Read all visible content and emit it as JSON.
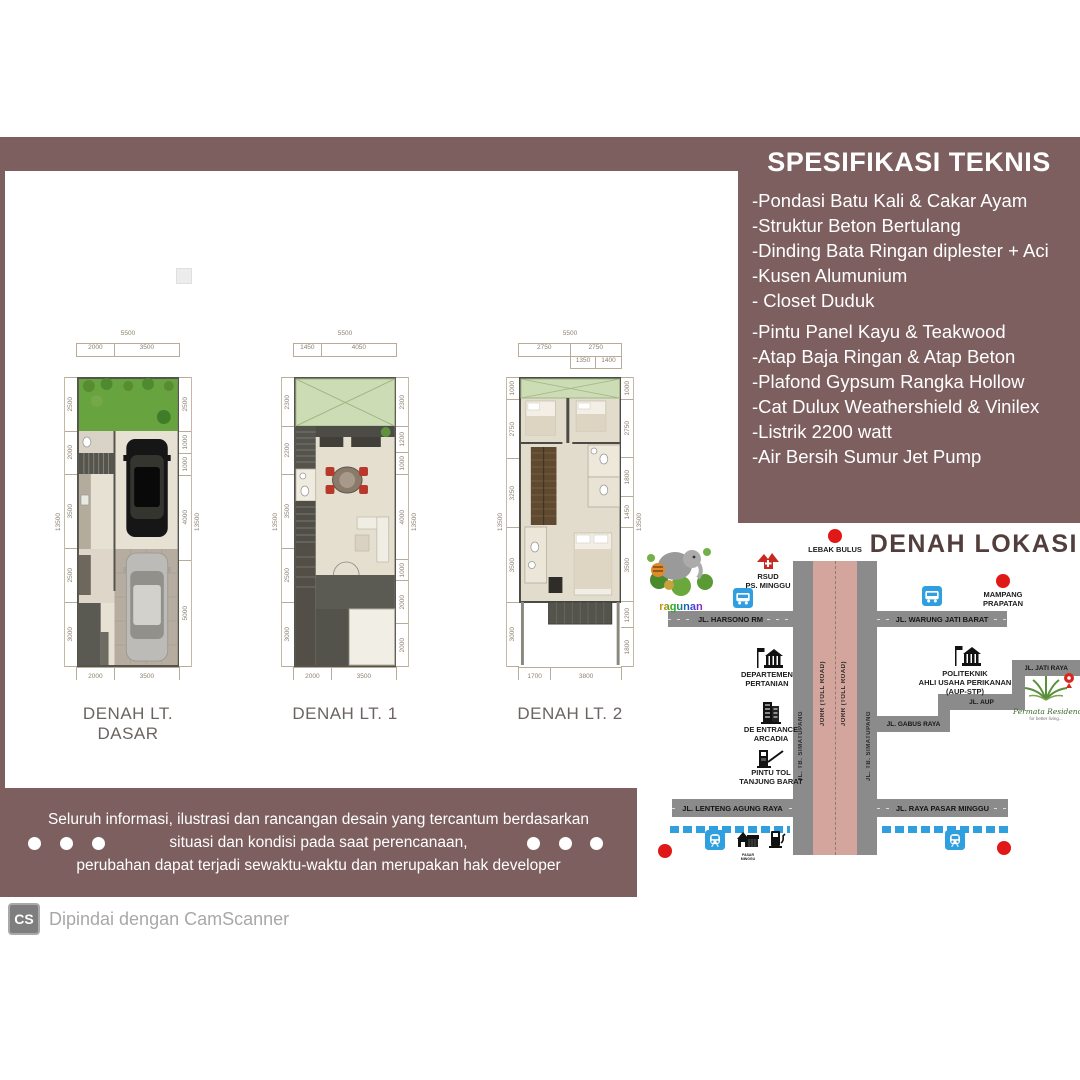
{
  "colors": {
    "panel_brown": "#7d5f5f",
    "road_gray": "#8b8b8b",
    "toll_pink": "#d3a59c",
    "map_title": "#523f3d",
    "accent_red": "#e01818",
    "bus_blue": "#2f9fe0"
  },
  "spec": {
    "title": "SPESIFIKASI TEKNIS",
    "items": [
      "-Pondasi Batu Kali & Cakar Ayam",
      "-Struktur Beton Bertulang",
      "-Dinding Bata Ringan diplester + Aci",
      "-Kusen Alumunium",
      "- Closet Duduk",
      "-Pintu Panel Kayu & Teakwood",
      "-Atap Baja Ringan & Atap Beton",
      "-Plafond Gypsum Rangka Hollow",
      "-Cat Dulux Weathershield & Vinilex",
      "-Listrik 2200 watt",
      "-Air Bersih Sumur Jet Pump"
    ]
  },
  "plans": [
    {
      "label": "DENAH LT. DASAR",
      "width_total": 5500,
      "height_total": 13500,
      "top": [
        2000,
        3500
      ],
      "bottom": [
        2000,
        3500
      ],
      "left": [
        2500,
        2000,
        3500,
        2500,
        3000
      ],
      "right": [
        2500,
        1000,
        1000,
        4000,
        5000
      ]
    },
    {
      "label": "DENAH LT. 1",
      "width_total": 5500,
      "height_total": 13500,
      "top": [
        1450,
        4050
      ],
      "bottom": [
        2000,
        3500
      ],
      "left": [
        2300,
        2200,
        3500,
        2500,
        3000
      ],
      "right": [
        2300,
        1200,
        1000,
        4000,
        1000,
        2000,
        2000
      ]
    },
    {
      "label": "DENAH LT. 2",
      "width_total": 5500,
      "height_total": 13500,
      "top": [
        2750,
        2750
      ],
      "top_sub": [
        1350,
        1400
      ],
      "bottom": [
        1700,
        3800
      ],
      "left": [
        1000,
        2750,
        3250,
        3500,
        3000
      ],
      "right": [
        1000,
        2750,
        1800,
        1450,
        3500,
        1200,
        1800
      ]
    }
  ],
  "map": {
    "title": "DENAH LOKASI",
    "labels": {
      "lebak_bulus": "LEBAK BULUS",
      "rsud": "RSUD\nPS. MINGGU",
      "mampang": "MAMPANG\nPRAPATAN",
      "harsono": "JL. HARSONO RM",
      "warung_jati": "JL. WARUNG JATI BARAT",
      "dept_pertanian": "DEPARTEMEN\nPERTANIAN",
      "politeknik": "POLITEKNIK\nAHLI USAHA PERIKANAN\n(AUP-STP)",
      "jati_raya": "JL. JATI RAYA",
      "aup": "JL. AUP",
      "gabus_raya": "JL. GABUS RAYA",
      "de_entrance": "DE ENTRANCE\nARCADIA",
      "pintu_tol": "PINTU TOL\nTANJUNG BARAT",
      "lenteng": "JL. LENTENG AGUNG RAYA",
      "pasar_minggu_road": "JL. RAYA PASAR MINGGU",
      "jorr": "JORR (TOLL ROAD)",
      "tb_simatupang": "JL. TB. SIMATUPANG",
      "pasar_minggu_market": "PASAR MINGGU",
      "ragunan": "ragunan",
      "permata_name": "Permata Residence",
      "permata_tagline": "for better living..."
    }
  },
  "disclaimer": {
    "line1": "Seluruh informasi, ilustrasi dan rancangan desain yang tercantum berdasarkan",
    "line2": "situasi dan kondisi pada saat perencanaan,",
    "line3": "perubahan dapat terjadi sewaktu-waktu dan merupakan hak developer"
  },
  "footer": {
    "badge": "CS",
    "text": "Dipindai dengan CamScanner"
  },
  "watermark": "ain"
}
